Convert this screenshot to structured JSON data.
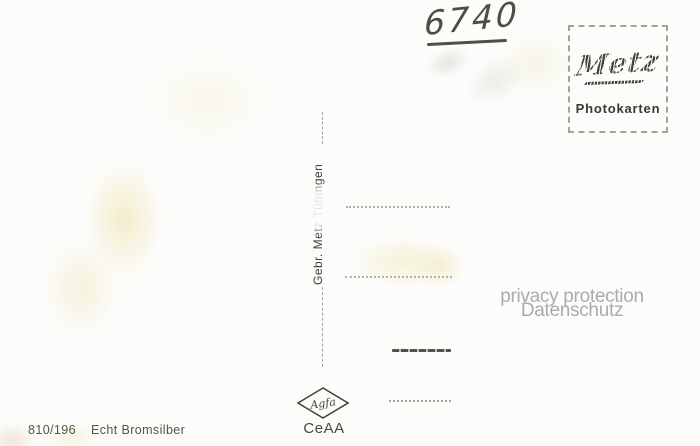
{
  "postcard": {
    "handwritten_number": "6740",
    "stamp_box": {
      "brand": "Metz",
      "caption": "Photokarten"
    },
    "publisher_imprint": "Gebr. Metz Tübingen",
    "privacy_watermark": {
      "line1": "privacy protection",
      "line2": "Datenschutz"
    },
    "footer": {
      "code": "810/196",
      "paper_label": "Echt Bromsilber",
      "film_logo": "Agfa",
      "mark": "CeAA"
    },
    "address_lines_count": 4,
    "colors": {
      "paper": "#fcfcfa",
      "print_dark": "#3f3d35",
      "line_light": "#b6b3a8",
      "line_dark": "#54514a",
      "watermark_gray": "#ababab",
      "handwriting": "#4f4b45",
      "stain_yellow": "#ece0a4"
    }
  }
}
